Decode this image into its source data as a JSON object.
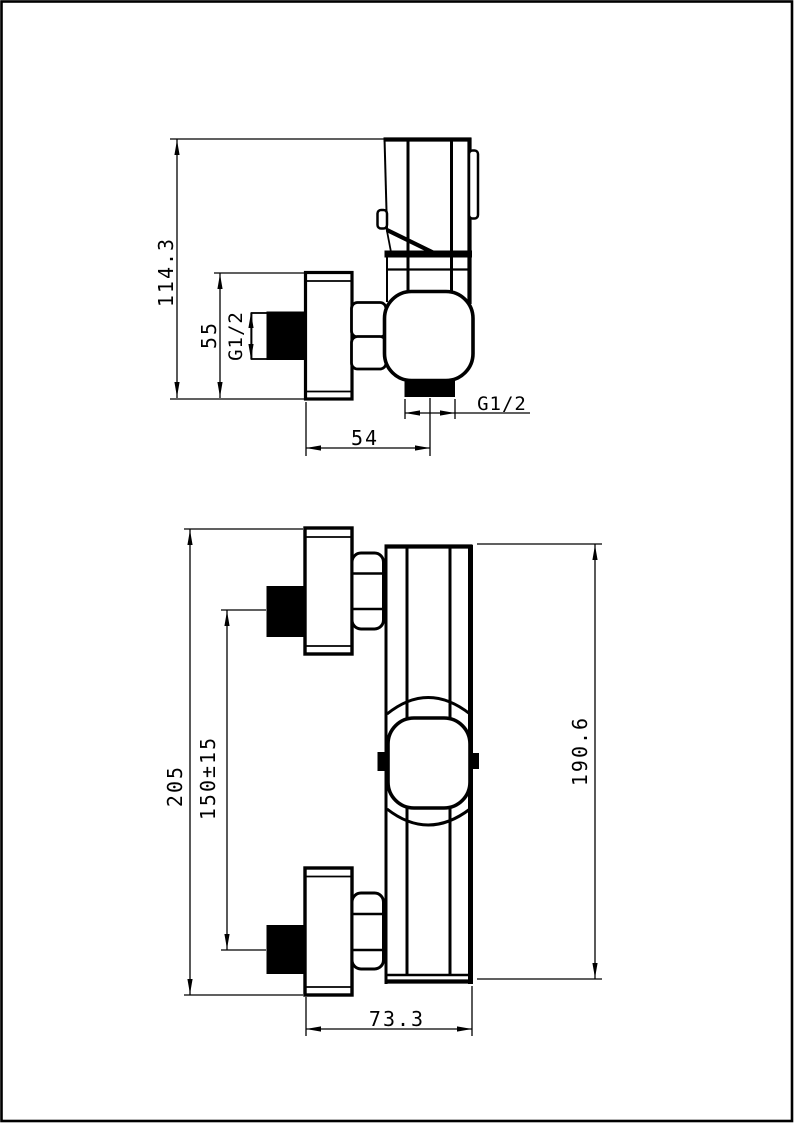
{
  "page": {
    "background": "#ffffff",
    "line_color": "#000000",
    "description": "Technical dimension drawing of a wall-mounted shower mixer valve, two orthographic views"
  },
  "views": {
    "side_view": {
      "name": "side-view",
      "dimensions": {
        "overall_height": "114.3",
        "escutcheon_height": "55",
        "inlet_thread": "G1/2",
        "outlet_offset": "54",
        "outlet_thread": "G1/2"
      }
    },
    "front_view": {
      "name": "front-view",
      "dimensions": {
        "overall_height": "205",
        "inlet_spacing": "150±15",
        "body_height": "190.6",
        "body_width": "73.3"
      }
    }
  }
}
